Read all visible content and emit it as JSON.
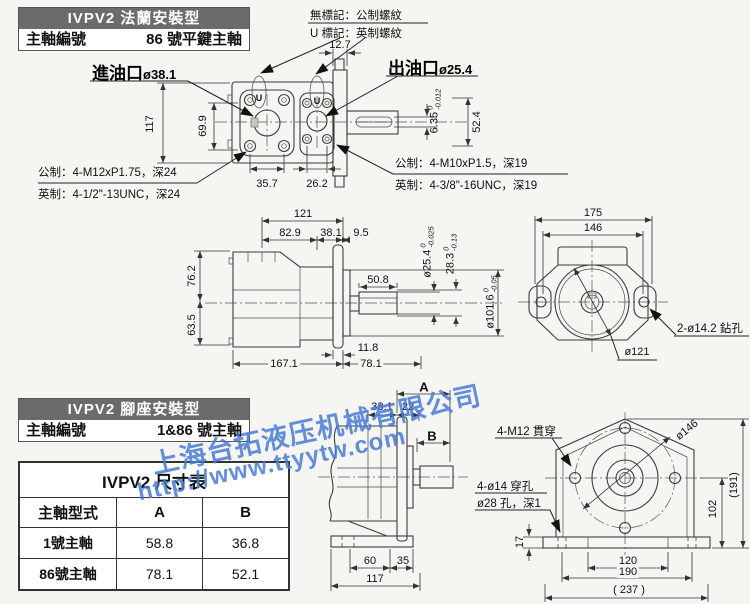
{
  "watermark": {
    "company": "上海台拓液压机械有限公司",
    "url": "http://www.ttyytw.com"
  },
  "flange": {
    "title": "IVPV2 法蘭安裝型",
    "spindle_label": "主軸編號",
    "spindle_value": "86 號平鍵主軸",
    "note_no_mark": "無標記：公制螺紋",
    "note_u_mark": "U 標記：英制螺紋",
    "u_symbol": "U",
    "inlet_name": "進油口",
    "inlet_dia": "ø38.1",
    "outlet_name": "出油口",
    "outlet_dia": "ø25.4",
    "metric_front": "公制：4-M12xP1.75，深24",
    "imperial_front": "英制：4-1/2\"-13UNC，深24",
    "metric_out": "公制：4-M10xP1.5，深19",
    "imperial_out": "英制：4-3/8\"-16UNC，深19",
    "dim_12_7": "12.7",
    "dim_117": "117",
    "dim_69_9": "69.9",
    "dim_35_7": "35.7",
    "dim_26_2": "26.2",
    "dim_52_4": "52.4",
    "tol_6_35": {
      "main": "6.35",
      "upper": "0",
      "lower": "-0.012"
    }
  },
  "side": {
    "dim_121": "121",
    "dim_82_9": "82.9",
    "dim_38_1": "38.1",
    "dim_9_5": "9.5",
    "dim_50_8": "50.8",
    "dim_76_2": "76.2",
    "dim_63_5": "63.5",
    "dim_11_8": "11.8",
    "dim_167_1": "167.1",
    "dim_78_1": "78.1",
    "tol_25_4": {
      "main": "ø25.4",
      "upper": "0",
      "lower": "-0.025"
    },
    "tol_28_3": {
      "main": "28.3",
      "upper": "0",
      "lower": "-0.13"
    },
    "tol_101_6": {
      "main": "ø101.6",
      "upper": "0",
      "lower": "-0.05"
    }
  },
  "rear": {
    "dim_175": "175",
    "dim_146": "146",
    "drill_note": "2-ø14.2 鉆孔",
    "dia_121": "ø121"
  },
  "foot": {
    "title": "IVPV2 腳座安裝型",
    "spindle_label": "主軸編號",
    "spindle_value": "1&86 號主軸",
    "table": {
      "title": "IVPV2 尺寸表",
      "headers": [
        "主軸型式",
        "A",
        "B"
      ],
      "rows": [
        [
          "1號主軸",
          "58.8",
          "36.8"
        ],
        [
          "86號主軸",
          "78.1",
          "52.1"
        ]
      ]
    },
    "dim_A": "A",
    "dim_38_1": "38.1",
    "dim_22": "22",
    "dim_B": "B",
    "dim_60": "60",
    "dim_35": "35",
    "dim_117": "117",
    "note_m12": "4-M12 貫穿",
    "dia_146": "ø146",
    "note_holes": "4-ø14 穿孔",
    "note_d28": "ø28 孔，深1",
    "dim_17": "17",
    "dim_102": "102",
    "dim_191": "(191)",
    "dim_120": "120",
    "dim_190": "190",
    "dim_237": "( 237 )"
  }
}
